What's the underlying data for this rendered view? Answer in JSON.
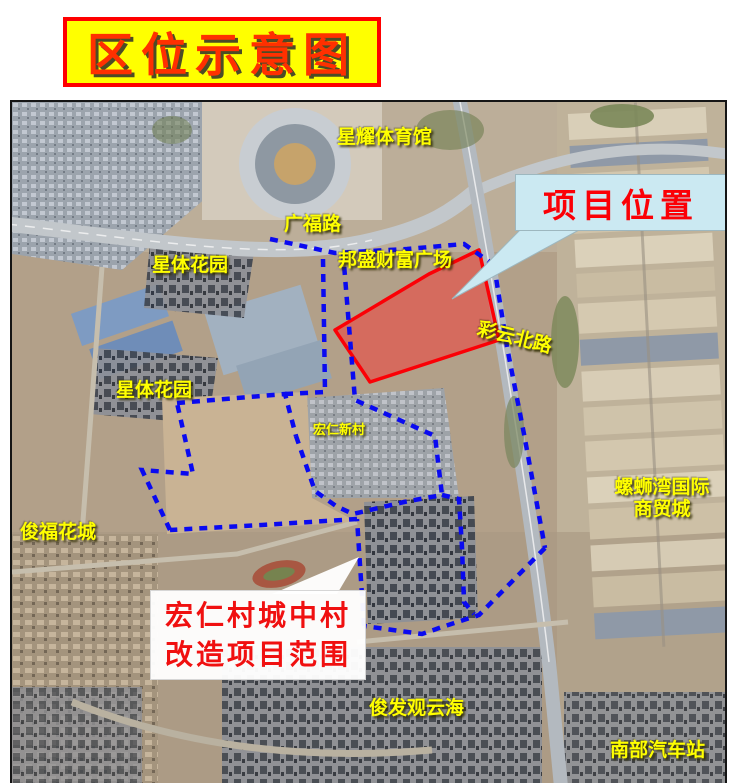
{
  "title": "区位示意图",
  "map": {
    "labels": {
      "stadium": "星耀体育馆",
      "guangfu_road": "广福路",
      "xingti_garden_upper": "星体花园",
      "xingti_garden_lower": "星体花园",
      "bangsheng_plaza": "邦盛财富广场",
      "caiyun_north_road": "彩云北路",
      "luosiwan_line1": "螺蛳湾国际",
      "luosiwan_line2": "商贸城",
      "hongren_village": "宏仁新村",
      "junfu_huacheng": "俊福花城",
      "junfa_guanyunhai": "俊发观云海",
      "south_bus_station": "南部汽车站"
    },
    "callouts": {
      "project_location": "项目位置",
      "project_scope_line1": "宏仁村城中村",
      "project_scope_line2": "改造项目范围"
    },
    "colors": {
      "boundary_blue": "#0a0af0",
      "project_red": "#fb0006",
      "label_yellow": "#ffff00",
      "location_callout_bg": "#cbe9f2",
      "scope_callout_bg": "#ffffff",
      "title_bg": "#ffff00",
      "title_text": "#ff3000"
    }
  }
}
